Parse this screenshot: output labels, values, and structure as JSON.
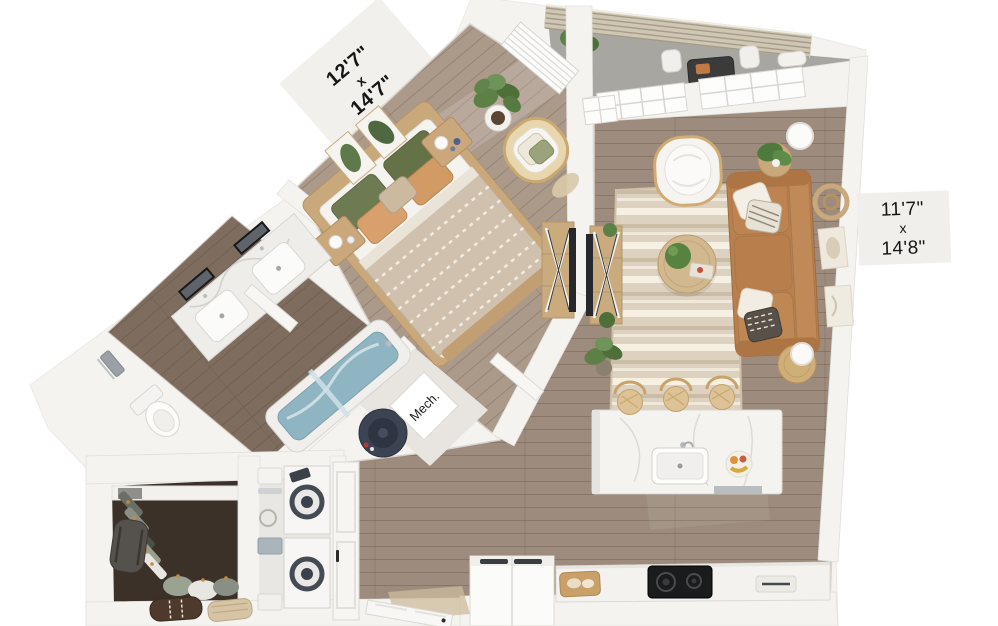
{
  "labels": {
    "bedroom_dimensions": {
      "line1": "12'7\"",
      "line2": "x",
      "line3": "14'7\""
    },
    "living_dimensions": {
      "line1": "11'7\"",
      "line2": "x",
      "line3": "14'8\""
    },
    "mechanical_closet": {
      "label": "Mech."
    }
  },
  "palette": {
    "background": "#ffffff",
    "wall": "#f4f3f0",
    "wall_edge": "#e6e3de",
    "floor_wood": "#9d8c7d",
    "floor_wood_light": "#ab998a",
    "floor_bathroom": "#7e6d5e",
    "floor_closet": "#3c3128",
    "balcony_floor": "#a7a6a1",
    "fence_slats": "#cfc7b4",
    "rug_base": "#ddd2c0",
    "rug_stripe": "#ece4d3",
    "sofa_leather": "#b8804f",
    "armchair_boucle": "#f6f4f1",
    "wood_furniture": "#c9a97c",
    "bed_duvet": "#cfc1ae",
    "pillow_green": "#6d7a52",
    "pillow_tan": "#d7a06c",
    "marble": "#f4f3f0",
    "tub_water": "#8fb4c2",
    "plant_green": "#5d8047",
    "water_heater": "#3c4454",
    "cooktop_black": "#1a1b1d",
    "label_text": "#161616",
    "label_tab_bg": "#f0efec"
  }
}
